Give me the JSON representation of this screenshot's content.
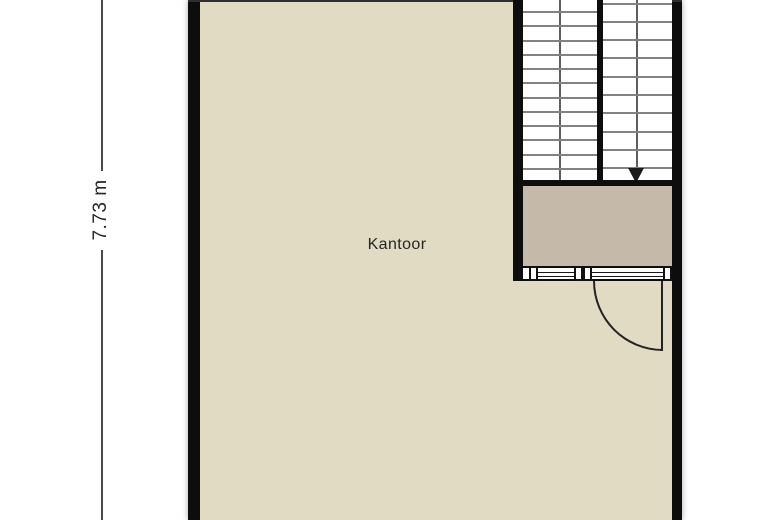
{
  "floorplan": {
    "dimension": {
      "label": "7.73 m"
    },
    "room": {
      "label": "Kantoor"
    },
    "stairs": {
      "left_flight_tread_lines": 12,
      "right_flight_tread_lines": 10,
      "direction_icon": "down-arrow"
    },
    "colors": {
      "room_fill": "#e1dbc4",
      "landing_fill": "#c5baa9",
      "wall": "#0d0d0d",
      "tread_line": "#828282",
      "glazing_line": "#1a1a1a",
      "door_line": "#222222",
      "dimension_line": "#4a4a4a",
      "text": "#262626",
      "background": "#ffffff"
    }
  }
}
